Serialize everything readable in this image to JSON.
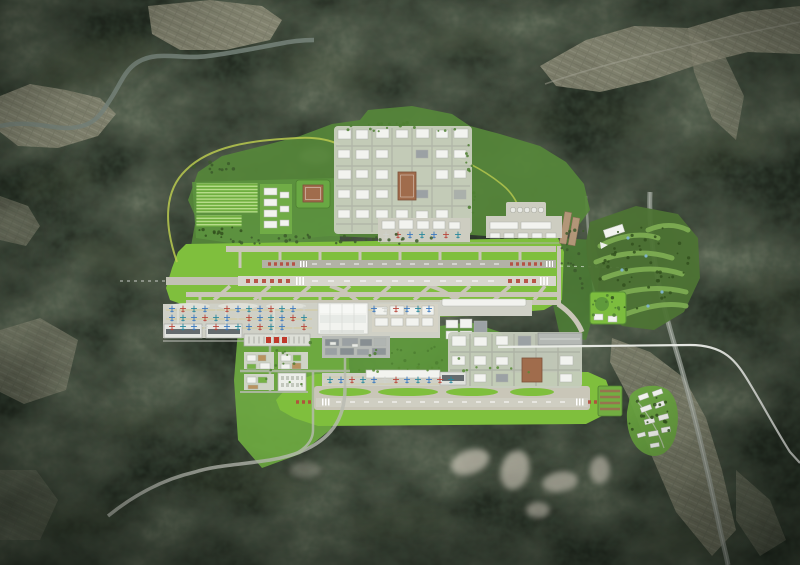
{
  "meta": {
    "type": "aerial-airport-masterplan-rendering",
    "canvas_w": 800,
    "canvas_h": 565
  },
  "palette": {
    "mountain": "#232b21",
    "ridge": "#46513b",
    "river": "#7c8a82",
    "quarry": "#cfc9bb",
    "road": "#b8bbb2",
    "highway": "#adb2ab",
    "whiteLine": "#eceee9",
    "greenway": "#b9c94f",
    "bufferGreen": "#568739",
    "wedgeGreen": "#4e7f35",
    "midGreen": "#619c3d",
    "landsideGreen": "#6fab41",
    "farmGreen": "#5d9440",
    "grass": "#7fbf3d",
    "beltGrass": "#7fbf3d",
    "pavement": "#c9c6b8",
    "runwayNorth": "#b2b2a6",
    "runwayMain": "#d7d6cc",
    "runwaySouth": "#cfcec2",
    "preThreshold": "#c2c1b4",
    "apron": "#cfd0c6",
    "pad": "#cdcdc1",
    "building": "#f2f3ef",
    "buildingStroke": "#adb1aa",
    "roofDark": "#646b6e",
    "court": "#a06c4c",
    "courtStroke": "#7c523a",
    "gtcRed": "#c0392b",
    "thresholdRed": "#b5493c",
    "marking": "#ffffff",
    "yellowLine": "#d8c05a",
    "water": "#7fb3c8",
    "golfBase": "#4d7334",
    "fairway": "#7fae54",
    "parkGreen": "#7cbd3e",
    "villageGreen": "#68a23f",
    "treeDark": "#33511f",
    "tanBuilding": "#b29678"
  },
  "scene": {
    "aircraft_colors": [
      "#3a78bf",
      "#b8453a",
      "#27879c",
      "#3a78bf",
      "#cfd2cc",
      "#b8453a",
      "#3a78bf",
      "#27879c"
    ],
    "aircraft_rows": [
      {
        "x0": 172,
        "y": 309,
        "count": 13,
        "step": 11
      },
      {
        "x0": 374,
        "y": 309,
        "count": 6,
        "step": 11
      },
      {
        "x0": 172,
        "y": 318,
        "count": 13,
        "step": 11
      },
      {
        "x0": 172,
        "y": 327,
        "count": 13,
        "step": 11
      },
      {
        "x0": 386,
        "y": 235,
        "count": 7,
        "step": 12
      },
      {
        "x0": 330,
        "y": 380,
        "count": 12,
        "step": 11
      }
    ],
    "ridges": [
      [
        95,
        62,
        62,
        24,
        -15,
        0.3
      ],
      [
        330,
        72,
        52,
        18,
        10,
        0.22
      ],
      [
        465,
        42,
        40,
        15,
        0,
        0.2
      ],
      [
        118,
        262,
        46,
        18,
        20,
        0.26
      ],
      [
        58,
        182,
        40,
        15,
        -10,
        0.22
      ],
      [
        525,
        122,
        46,
        16,
        0,
        0.2
      ],
      [
        722,
        152,
        50,
        20,
        -20,
        0.26
      ],
      [
        770,
        300,
        34,
        28,
        0,
        0.22
      ],
      [
        240,
        482,
        62,
        22,
        10,
        0.26
      ],
      [
        400,
        522,
        50,
        18,
        -5,
        0.22
      ],
      [
        682,
        542,
        44,
        16,
        0,
        0.2
      ],
      [
        140,
        422,
        40,
        14,
        0,
        0.2
      ],
      [
        620,
        120,
        40,
        16,
        15,
        0.2
      ],
      [
        70,
        520,
        50,
        18,
        0,
        0.22
      ]
    ],
    "tree_clusters": [
      {
        "cx": 330,
        "cy": 239,
        "rx": 120,
        "ry": 6,
        "n": 34,
        "seed": 3,
        "color": "#3c5a2b"
      },
      {
        "cx": 222,
        "cy": 232,
        "rx": 26,
        "ry": 6,
        "n": 12,
        "seed": 5,
        "color": "#33511f"
      },
      {
        "cx": 644,
        "cy": 268,
        "rx": 46,
        "ry": 44,
        "n": 46,
        "seed": 7,
        "color": "#33511f"
      },
      {
        "cx": 652,
        "cy": 422,
        "rx": 24,
        "ry": 28,
        "n": 16,
        "seed": 9,
        "color": "#33511f"
      },
      {
        "cx": 606,
        "cy": 308,
        "rx": 15,
        "ry": 13,
        "n": 10,
        "seed": 11,
        "color": "#4e7f31"
      },
      {
        "cx": 402,
        "cy": 127,
        "rx": 66,
        "ry": 5,
        "n": 18,
        "seed": 13,
        "color": "#4e7f31"
      },
      {
        "cx": 470,
        "cy": 180,
        "rx": 6,
        "ry": 38,
        "n": 12,
        "seed": 15,
        "color": "#4e7f31"
      },
      {
        "cx": 575,
        "cy": 258,
        "rx": 16,
        "ry": 34,
        "n": 16,
        "seed": 17,
        "color": "#3c5a2b"
      },
      {
        "cx": 420,
        "cy": 356,
        "rx": 58,
        "ry": 10,
        "n": 16,
        "seed": 19,
        "color": "#4e7f31"
      },
      {
        "cx": 292,
        "cy": 362,
        "rx": 38,
        "ry": 24,
        "n": 12,
        "seed": 21,
        "color": "#4e7f31"
      },
      {
        "cx": 450,
        "cy": 370,
        "rx": 120,
        "ry": 3,
        "n": 16,
        "seed": 23,
        "color": "#568c33"
      },
      {
        "cx": 216,
        "cy": 170,
        "rx": 30,
        "ry": 8,
        "n": 10,
        "seed": 25,
        "color": "#3c5a2b"
      }
    ],
    "fairways": [
      "M600,246 C618,236 640,232 658,238",
      "M596,262 C620,252 648,250 672,258",
      "M604,278 C630,268 658,266 682,274",
      "M612,296 C636,288 662,286 686,292",
      "M626,314 C648,306 668,302 686,306",
      "M648,230 C662,224 676,224 688,230"
    ],
    "ponds": [
      [
        628,
        238
      ],
      [
        646,
        256
      ],
      [
        622,
        270
      ],
      [
        662,
        292
      ],
      [
        648,
        306
      ],
      [
        598,
        299
      ],
      [
        616,
        301
      ]
    ],
    "buildings": {
      "north_campus": [
        [
          338,
          130,
          13,
          9
        ],
        [
          356,
          130,
          12,
          9
        ],
        [
          376,
          129,
          13,
          9
        ],
        [
          396,
          130,
          12,
          8
        ],
        [
          416,
          129,
          13,
          9
        ],
        [
          436,
          130,
          12,
          8
        ],
        [
          454,
          129,
          14,
          9
        ],
        [
          338,
          150,
          12,
          8
        ],
        [
          356,
          150,
          13,
          9
        ],
        [
          376,
          150,
          12,
          8
        ],
        [
          436,
          150,
          12,
          8
        ],
        [
          454,
          150,
          12,
          8
        ],
        [
          338,
          170,
          13,
          9
        ],
        [
          356,
          170,
          12,
          8
        ],
        [
          376,
          170,
          12,
          9
        ],
        [
          436,
          170,
          12,
          9
        ],
        [
          454,
          170,
          12,
          8
        ],
        [
          338,
          190,
          12,
          8
        ],
        [
          356,
          190,
          13,
          9
        ],
        [
          376,
          190,
          12,
          8
        ],
        [
          338,
          210,
          12,
          8
        ],
        [
          356,
          210,
          13,
          8
        ],
        [
          376,
          210,
          12,
          8
        ],
        [
          396,
          210,
          12,
          8
        ],
        [
          416,
          211,
          12,
          8
        ],
        [
          436,
          210,
          12,
          8
        ],
        [
          416,
          150,
          12,
          8,
          "#9ba1a4"
        ],
        [
          416,
          190,
          12,
          8,
          "#9ba1a4"
        ],
        [
          454,
          190,
          12,
          9,
          "#aab0ab"
        ]
      ],
      "mid_blocks": [
        [
          375,
          307,
          12,
          8
        ],
        [
          390,
          306,
          14,
          9
        ],
        [
          407,
          307,
          12,
          8
        ],
        [
          422,
          306,
          12,
          9
        ],
        [
          375,
          318,
          13,
          8
        ],
        [
          391,
          318,
          12,
          8
        ],
        [
          406,
          318,
          13,
          8
        ],
        [
          422,
          318,
          11,
          8
        ],
        [
          446,
          320,
          12,
          8
        ],
        [
          460,
          319,
          12,
          9
        ],
        [
          474,
          321,
          13,
          12,
          "#9ba1a4"
        ],
        [
          446,
          331,
          12,
          8
        ],
        [
          460,
          331,
          12,
          8
        ]
      ],
      "gray_complex": [
        [
          325,
          339,
          14,
          7,
          "#878e92"
        ],
        [
          342,
          338,
          16,
          8,
          "#9aa0a3"
        ],
        [
          360,
          339,
          12,
          7,
          "#878e92"
        ],
        [
          374,
          338,
          12,
          8,
          "#b0b5b2"
        ],
        [
          325,
          348,
          12,
          7,
          "#9aa0a3"
        ],
        [
          340,
          348,
          14,
          7,
          "#878e92"
        ],
        [
          357,
          349,
          12,
          6,
          "#9aa0a3"
        ],
        [
          372,
          348,
          14,
          7,
          "#8e9598"
        ],
        [
          330,
          342,
          6,
          3,
          "#e8eae6"
        ],
        [
          352,
          344,
          6,
          3,
          "#e8eae6"
        ]
      ],
      "nw_column": [
        [
          264,
          188,
          13,
          7
        ],
        [
          264,
          199,
          13,
          7
        ],
        [
          264,
          210,
          13,
          7
        ],
        [
          264,
          221,
          13,
          7
        ],
        [
          280,
          192,
          9,
          6
        ],
        [
          280,
          206,
          9,
          6
        ],
        [
          280,
          220,
          9,
          6
        ]
      ],
      "north_apron_west": [
        [
          382,
          221,
          13,
          8
        ],
        [
          399,
          220,
          14,
          9
        ],
        [
          417,
          221,
          12,
          8
        ],
        [
          433,
          221,
          12,
          8
        ],
        [
          449,
          222,
          11,
          7
        ]
      ],
      "north_apron_east": [
        [
          490,
          222,
          28,
          7
        ],
        [
          521,
          222,
          30,
          7
        ],
        [
          490,
          233,
          10,
          5
        ],
        [
          504,
          233,
          10,
          5
        ],
        [
          518,
          233,
          10,
          5
        ],
        [
          532,
          233,
          10,
          5
        ],
        [
          546,
          233,
          10,
          5
        ]
      ],
      "se_campus": [
        [
          452,
          336,
          14,
          10
        ],
        [
          474,
          337,
          13,
          9
        ],
        [
          496,
          336,
          12,
          9
        ],
        [
          452,
          356,
          13,
          9
        ],
        [
          474,
          356,
          12,
          9
        ],
        [
          496,
          357,
          12,
          8
        ],
        [
          452,
          374,
          13,
          9
        ],
        [
          474,
          374,
          12,
          8
        ],
        [
          560,
          356,
          13,
          9
        ],
        [
          560,
          374,
          12,
          8
        ],
        [
          518,
          336,
          13,
          10,
          "#9ba1a4"
        ],
        [
          496,
          374,
          12,
          8,
          "#9ba1a4"
        ]
      ],
      "landside_pads": [
        [
          247,
          355,
          9,
          6
        ],
        [
          258,
          355,
          8,
          6,
          "#b8925f"
        ],
        [
          247,
          364,
          9,
          5,
          "#76b246"
        ],
        [
          260,
          363,
          10,
          6
        ],
        [
          281,
          355,
          10,
          6
        ],
        [
          293,
          355,
          8,
          6,
          "#76b246"
        ],
        [
          281,
          364,
          9,
          5
        ],
        [
          292,
          363,
          9,
          6,
          "#b8925f"
        ],
        [
          247,
          377,
          9,
          6
        ],
        [
          258,
          377,
          9,
          6,
          "#76b246"
        ],
        [
          248,
          385,
          10,
          4,
          "#b8925f"
        ]
      ],
      "park": [
        [
          594,
          314,
          9,
          6
        ],
        [
          608,
          316,
          9,
          6
        ]
      ]
    },
    "village_buildings": [
      [
        638,
        396,
        10,
        5,
        -20
      ],
      [
        652,
        392,
        10,
        5,
        -20
      ],
      [
        640,
        408,
        11,
        5,
        -20
      ],
      [
        654,
        404,
        10,
        5,
        -20
      ],
      [
        644,
        420,
        10,
        5,
        -15
      ],
      [
        658,
        416,
        10,
        5,
        -15
      ],
      [
        648,
        432,
        10,
        5,
        -10
      ],
      [
        661,
        428,
        9,
        5,
        -10
      ],
      [
        650,
        444,
        9,
        4,
        -10
      ],
      [
        637,
        434,
        8,
        4,
        -15
      ]
    ]
  }
}
